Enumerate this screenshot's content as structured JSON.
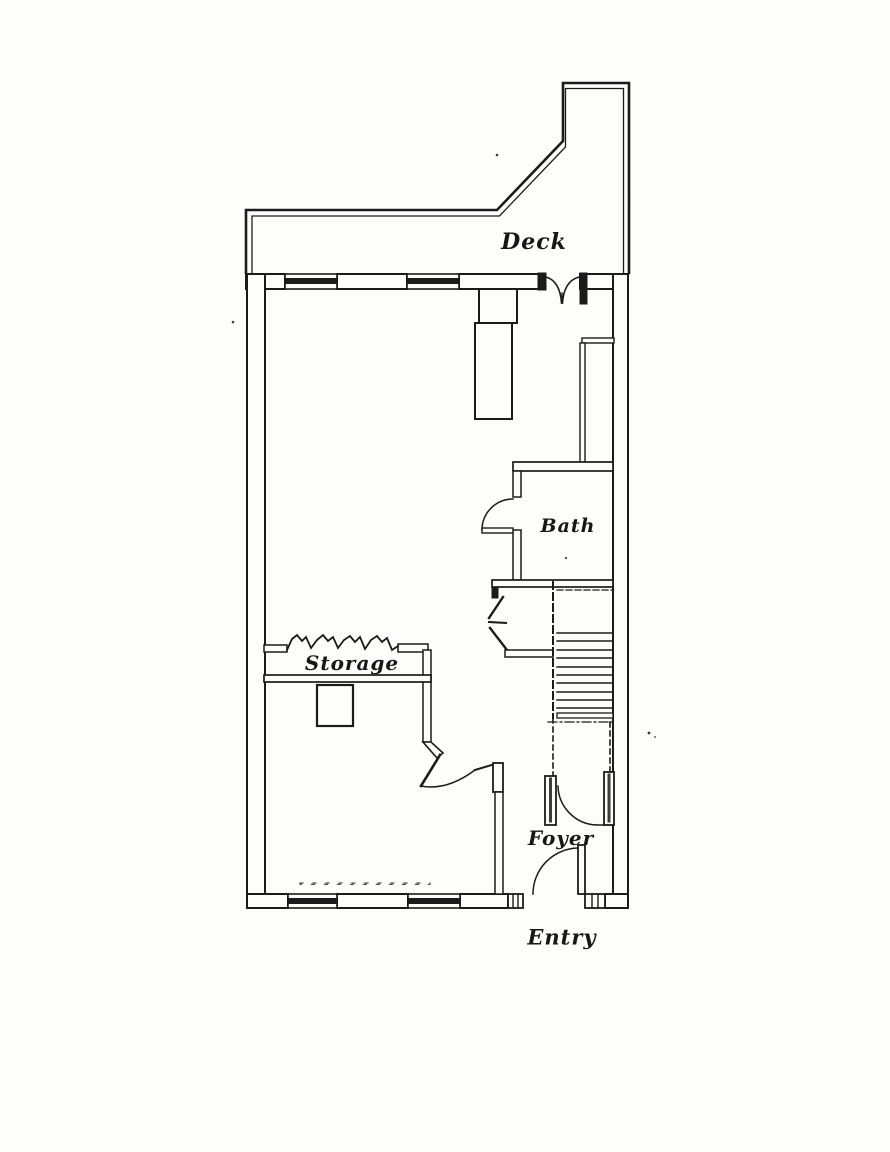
{
  "document": {
    "kind": "scanned architectural floor plan",
    "paper_color": "#fdfdfc",
    "ink_color": "#1b1b1b"
  },
  "labels": {
    "deck": "Deck",
    "bath": "Bath",
    "storage": "Storage",
    "foyer": "Foyer",
    "entry": "Entry"
  }
}
